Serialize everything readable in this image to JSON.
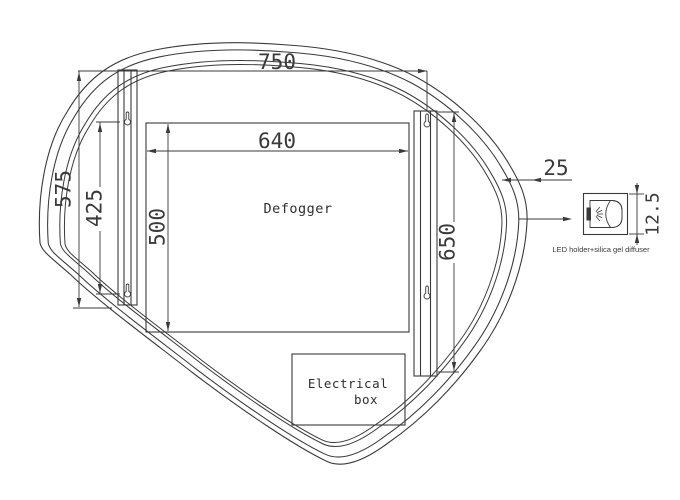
{
  "drawing": {
    "dimensions": {
      "overall_width": "750",
      "left_bar_length": "575",
      "mount_hole_spacing": "425",
      "defogger_height": "500",
      "defogger_width": "640",
      "right_bar_length": "650",
      "edge_channel_gap": "25",
      "led_holder_size": "12.5"
    },
    "labels": {
      "defogger": "Defogger",
      "electrical_line1": "Electrical",
      "electrical_line2": "box",
      "led_note": "LED holder+silica gel diffuser"
    },
    "colors": {
      "line": "#3a3a3a",
      "text": "#333333",
      "background": "#ffffff"
    }
  }
}
